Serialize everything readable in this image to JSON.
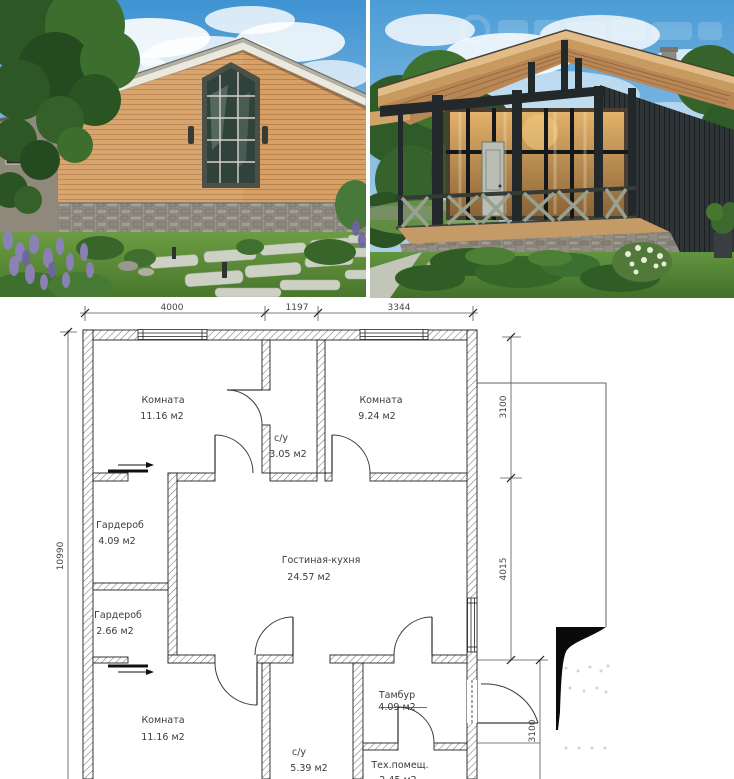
{
  "photos": {
    "left": {
      "name": "front facade render"
    },
    "right": {
      "name": "porch render"
    }
  },
  "plan": {
    "dims": {
      "top": [
        "4000",
        "1197",
        "3344"
      ],
      "left": "10990",
      "right": [
        "3100",
        "4015",
        "3100"
      ]
    },
    "rooms": [
      {
        "name": "Комната",
        "area": "11.16 м2"
      },
      {
        "name": "с/у",
        "area": "3.05 м2"
      },
      {
        "name": "Комната",
        "area": "9.24 м2"
      },
      {
        "name": "Гардероб",
        "area": "4.09 м2"
      },
      {
        "name": "Гардероб",
        "area": "2.66 м2"
      },
      {
        "name": "Гостиная-кухня",
        "area": "24.57 м2"
      },
      {
        "name": "Комната",
        "area": "11.16 м2"
      },
      {
        "name": "с/у",
        "area": "5.39 м2"
      },
      {
        "name": "Тамбур",
        "area": "4.09 м2"
      },
      {
        "name": "Тех.помещ.",
        "area": "2.45 м2"
      }
    ]
  },
  "colors": {
    "sky": "#4b9cd6",
    "wood_siding": "#d7a066",
    "dark_siding": "#2f3436",
    "lawn": "#5e9038",
    "plan_line": "#222222"
  }
}
